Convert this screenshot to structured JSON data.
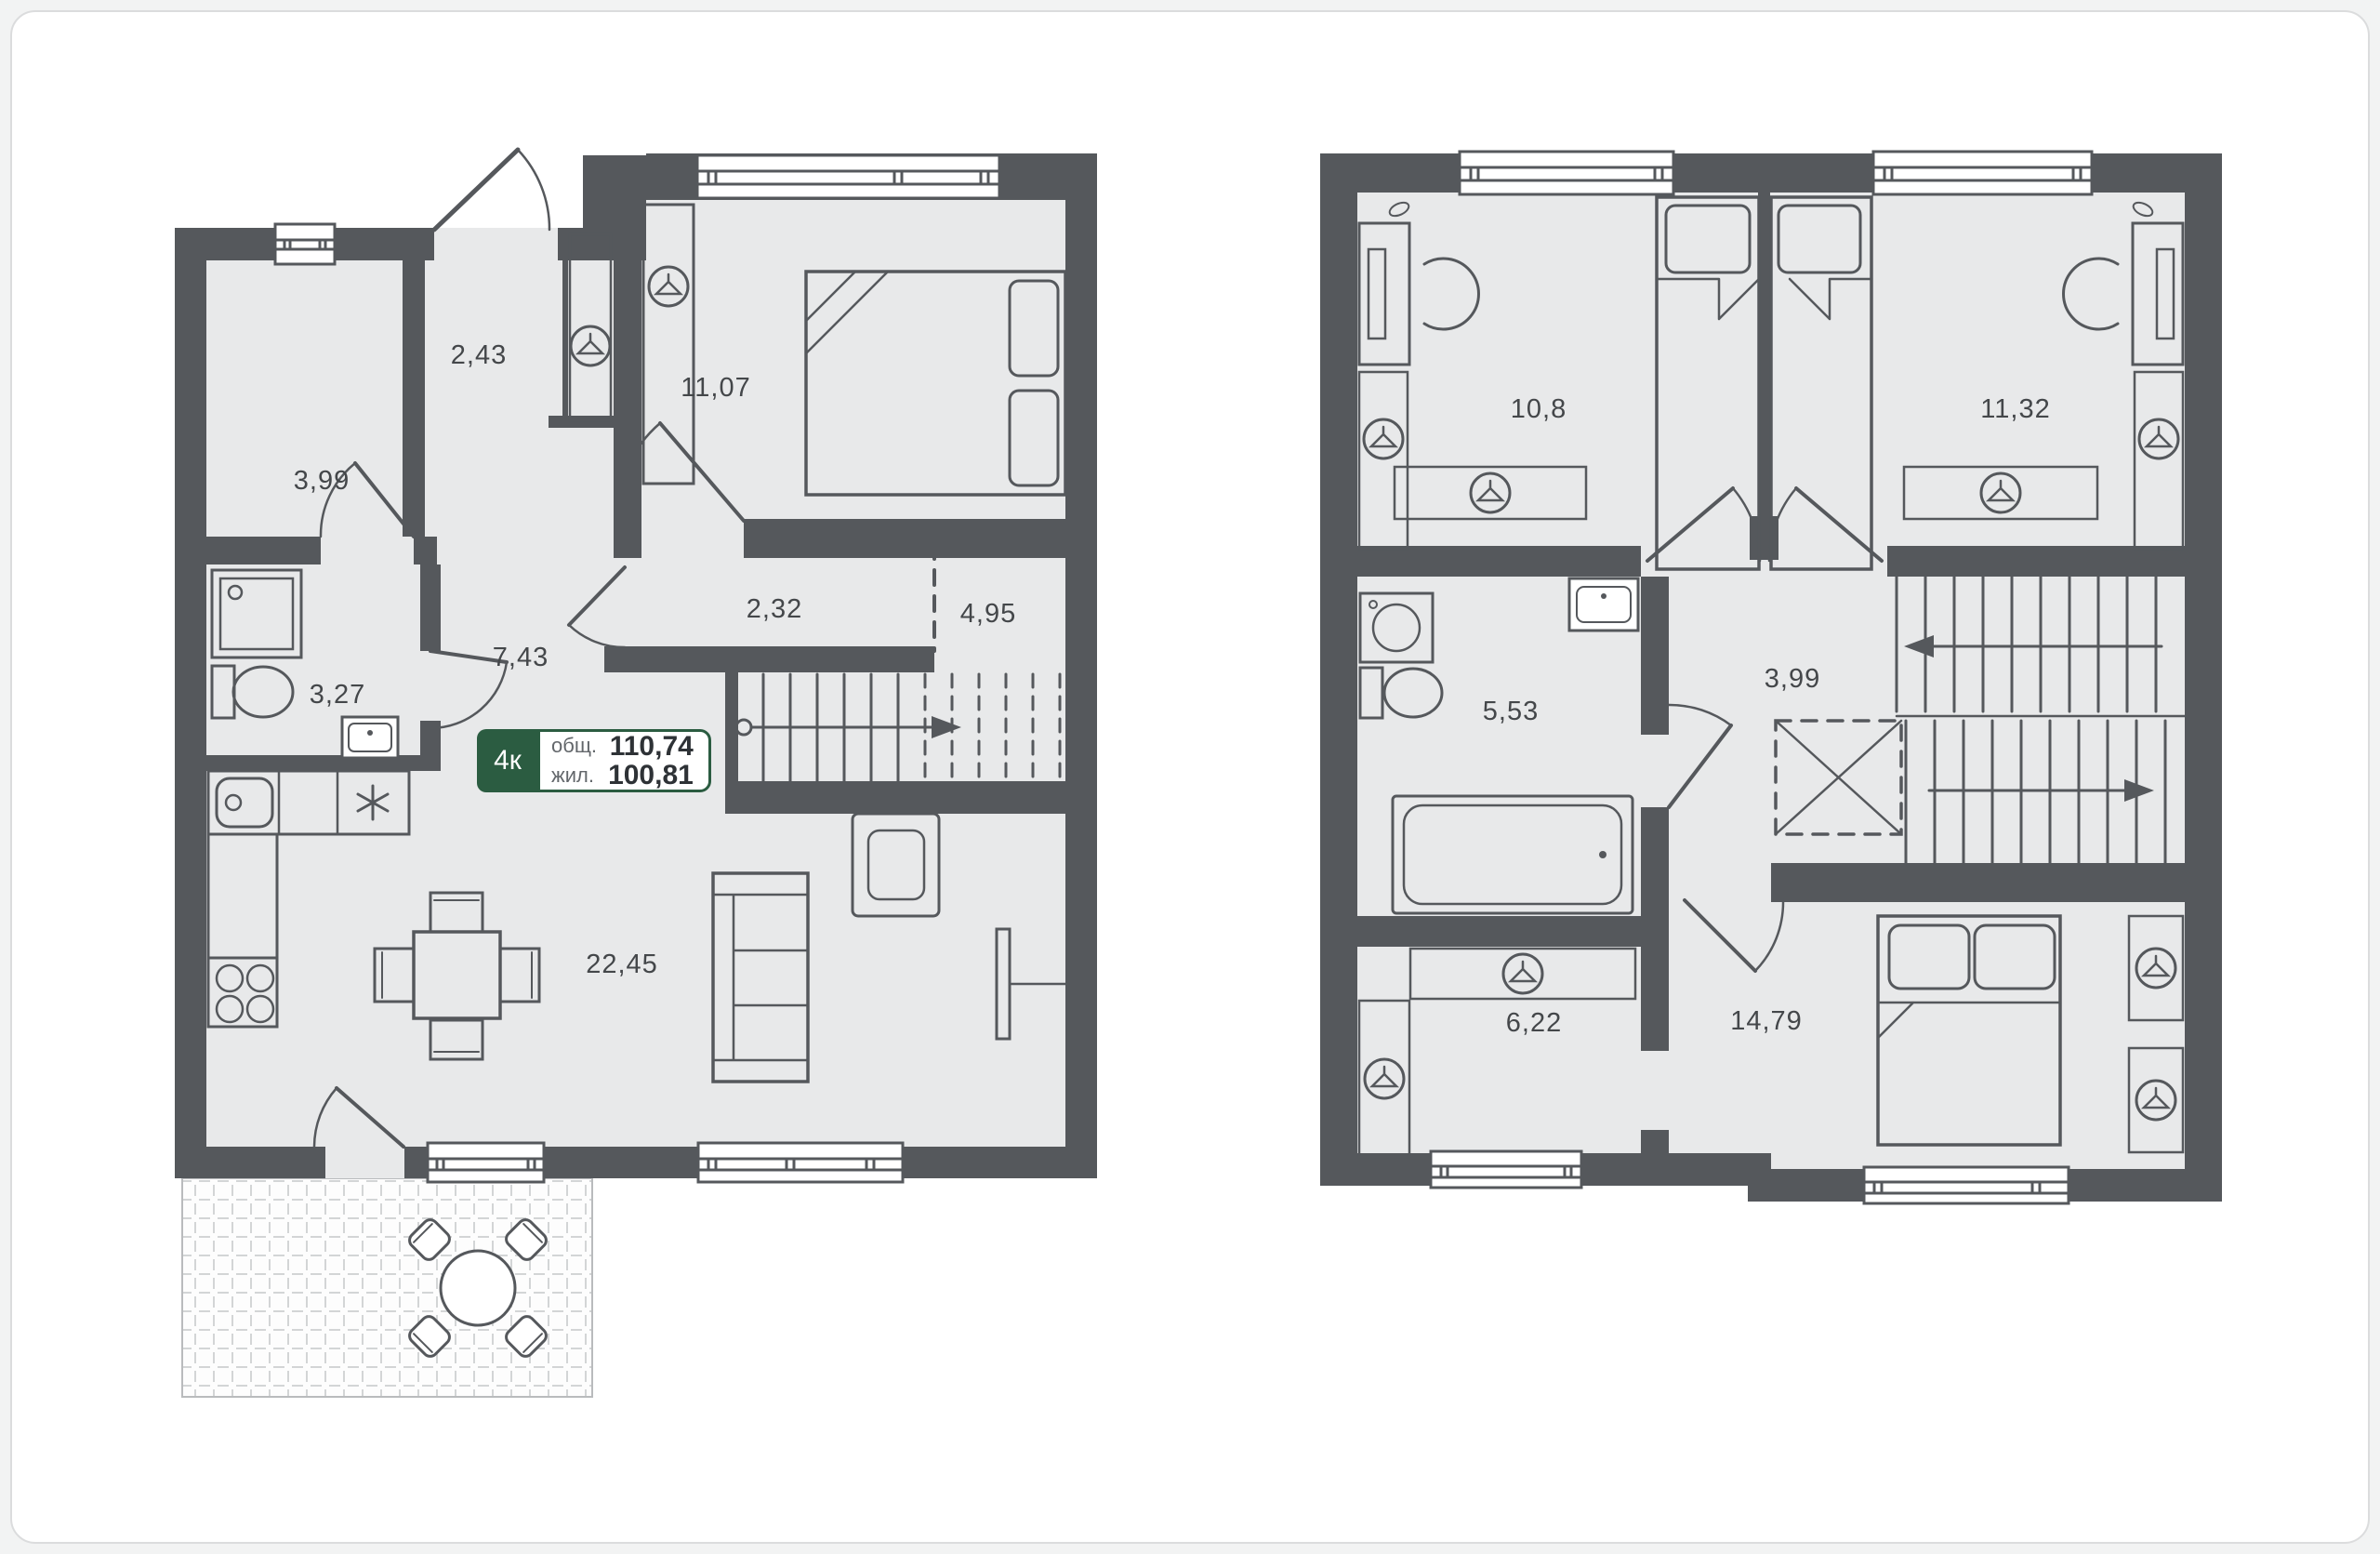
{
  "page": {
    "background": "#f2f3f3",
    "card_background": "#ffffff",
    "card_border": "#dbdcdd"
  },
  "colors": {
    "wall": "#55585c",
    "floor": "#e8e9ea",
    "furniture_line": "#55585c",
    "label_text": "#44474a",
    "badge_green": "#2b5c41",
    "terrace_pattern": "#d3d5d6"
  },
  "badge": {
    "rooms": "4к",
    "total_label": "общ.",
    "total_value": "110,74",
    "living_label": "жил.",
    "living_value": "100,81"
  },
  "floor1": {
    "rooms": [
      {
        "name": "entry-hall",
        "area": "2,43"
      },
      {
        "name": "pantry",
        "area": "3,99"
      },
      {
        "name": "bedroom",
        "area": "11,07"
      },
      {
        "name": "corridor",
        "area": "7,43"
      },
      {
        "name": "closet",
        "area": "2,32"
      },
      {
        "name": "stair-space",
        "area": "4,95"
      },
      {
        "name": "bathroom",
        "area": "3,27"
      },
      {
        "name": "kitchen-living-room",
        "area": "22,45"
      }
    ]
  },
  "floor2": {
    "rooms": [
      {
        "name": "bedroom-left",
        "area": "10,8"
      },
      {
        "name": "bedroom-right",
        "area": "11,32"
      },
      {
        "name": "bathroom",
        "area": "5,53"
      },
      {
        "name": "hall",
        "area": "3,99"
      },
      {
        "name": "wardrobe-room",
        "area": "6,22"
      },
      {
        "name": "master-bedroom",
        "area": "14,79"
      }
    ]
  },
  "icons": {
    "wardrobe": "hanger-icon",
    "shower": "shower-icon",
    "toilet": "toilet-icon",
    "sink": "sink-icon",
    "washing_machine": "washing-machine-icon",
    "bathtub": "bathtub-icon",
    "stove": "stove-burners-icon",
    "fridge": "asterisk-icon",
    "stairs_direction": "arrow-icon",
    "entry": "door-arc"
  }
}
